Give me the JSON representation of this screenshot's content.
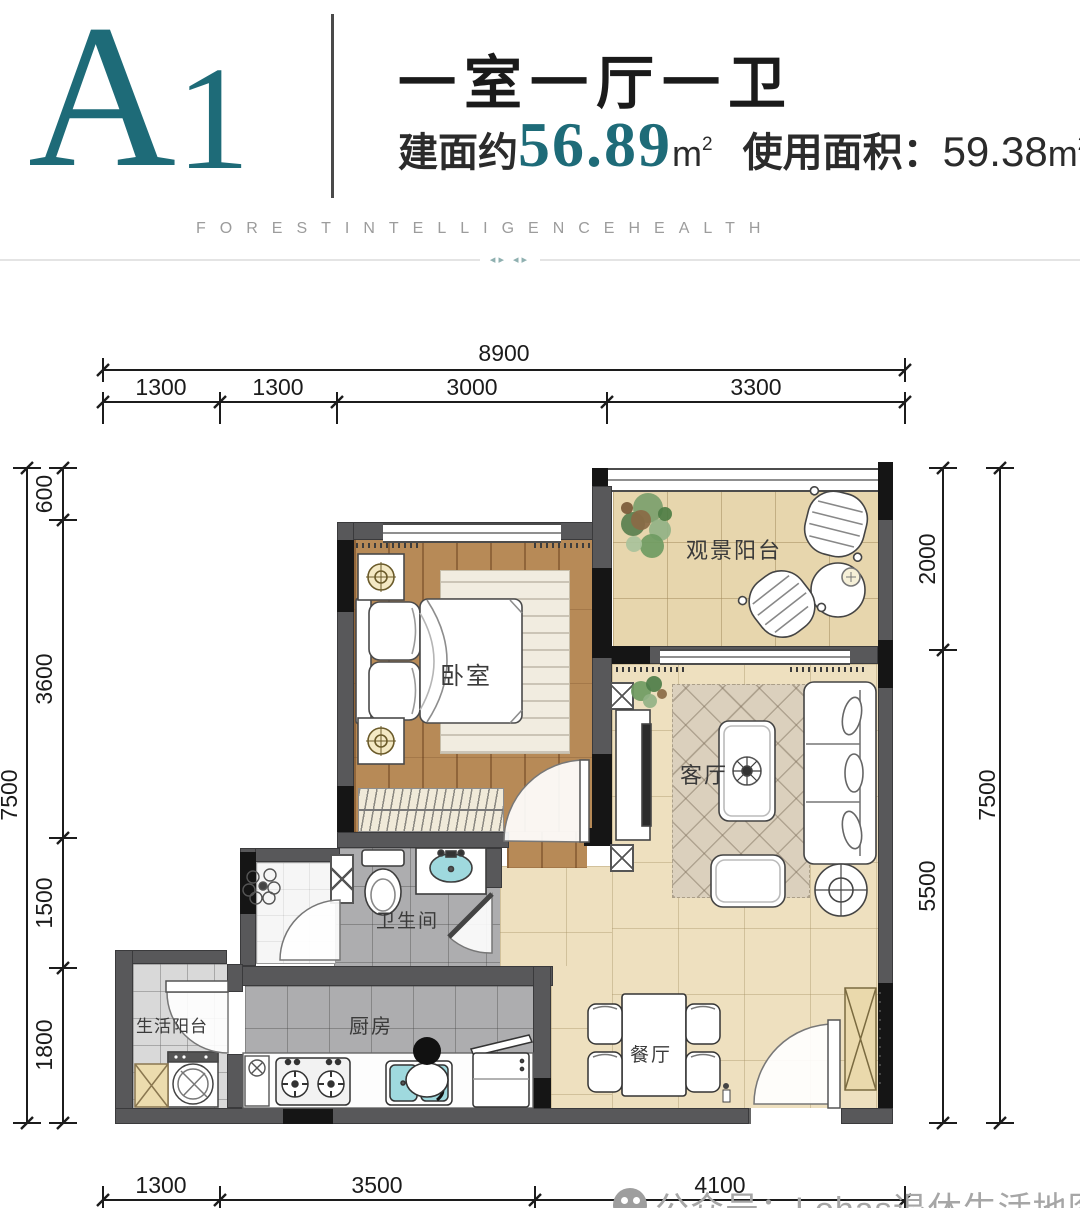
{
  "colors": {
    "accent_teal": "#1E6B78",
    "wall_gray": "#58585a",
    "wall_black": "#151515",
    "wood_floor": "#b78a57",
    "balcony_tile": "#e7d6ad",
    "living_tile": "#eee0bf",
    "bath_tile": "#adadaf",
    "sink_cyan": "#9fd9de",
    "cabinet_tan": "#ead9ac"
  },
  "header": {
    "unit_letter": "A",
    "unit_number": "1",
    "title": "一室一厅一卫",
    "area_label": "建面约",
    "area_value": "56.89",
    "area_unit": "m",
    "area_exp": "2",
    "usable_label": "使用面积：",
    "usable_value": "59.38",
    "usable_unit": "m",
    "usable_exp": "2",
    "tagline": "FORESTINTELLIGENCEHEALTH",
    "ornament": "◂▸ ◂▸"
  },
  "rooms": {
    "bedroom": "卧室",
    "view_balcony": "观景阳台",
    "living": "客厅",
    "bathroom": "卫生间",
    "kitchen": "厨房",
    "life_balcony": "生活阳台",
    "dining": "餐厅"
  },
  "dimensions": {
    "top": {
      "total": "8900",
      "segments": [
        "1300",
        "1300",
        "3000",
        "3300"
      ]
    },
    "bottom": {
      "segments": [
        "1300",
        "3500",
        "4100"
      ]
    },
    "left": {
      "total": "7500",
      "segments": [
        "600",
        "3600",
        "1500",
        "1800"
      ]
    },
    "right": {
      "total": "7500",
      "segments": [
        "2000",
        "5500"
      ]
    }
  },
  "watermark": {
    "text": "公众号：Lohas退休生活地图"
  },
  "furniture_icons": [
    "double-bed",
    "nightstand",
    "table-lamp",
    "wardrobe",
    "rug",
    "sofa",
    "coffee-table",
    "ottoman",
    "tv-cabinet",
    "floor-lamp",
    "plant",
    "balcony-chair",
    "balcony-table",
    "toilet",
    "wash-basin",
    "shower-head",
    "gas-stove",
    "kitchen-sink",
    "fridge",
    "washing-machine",
    "storage-cabinet",
    "dining-table",
    "dining-chair",
    "shoe-cabinet",
    "door-arc"
  ]
}
